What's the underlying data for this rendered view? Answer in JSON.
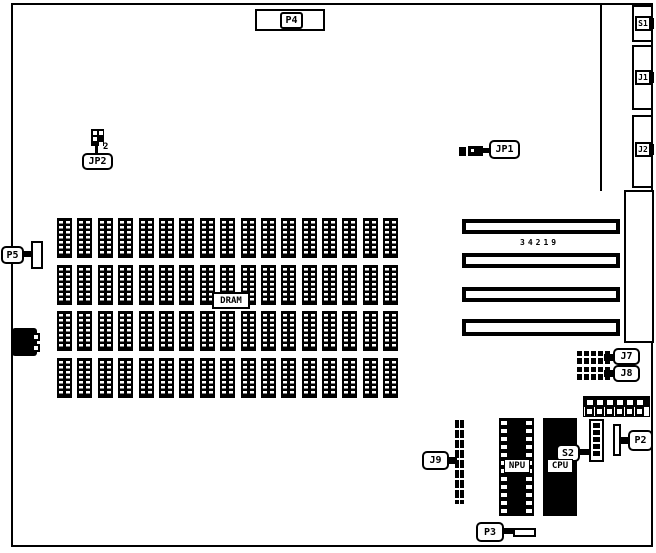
{
  "diagram": {
    "type": "motherboard-component-location-diagram",
    "colors": {
      "background": "#ffffff",
      "ink": "#000000"
    },
    "labels": {
      "p4": "P4",
      "s1": "S1",
      "j1": "J1",
      "j2": "J2",
      "jp1": "JP1",
      "jp2": "JP2",
      "jp2_pin_count": "2",
      "p5": "P5",
      "dram": "DRAM",
      "slot_marking": "34219",
      "j7": "J7",
      "j8": "J8",
      "j9": "J9",
      "npu": "NPU",
      "cpu": "CPU",
      "s2": "S2",
      "p2": "P2",
      "p3": "P3"
    },
    "dram_array": {
      "rows": 4,
      "chips_per_row": 17
    },
    "slots": {
      "count": 4
    },
    "header_block": {
      "top_pins": 6,
      "bottom_pins": 6
    },
    "s2_switch": {
      "positions": 5
    }
  }
}
